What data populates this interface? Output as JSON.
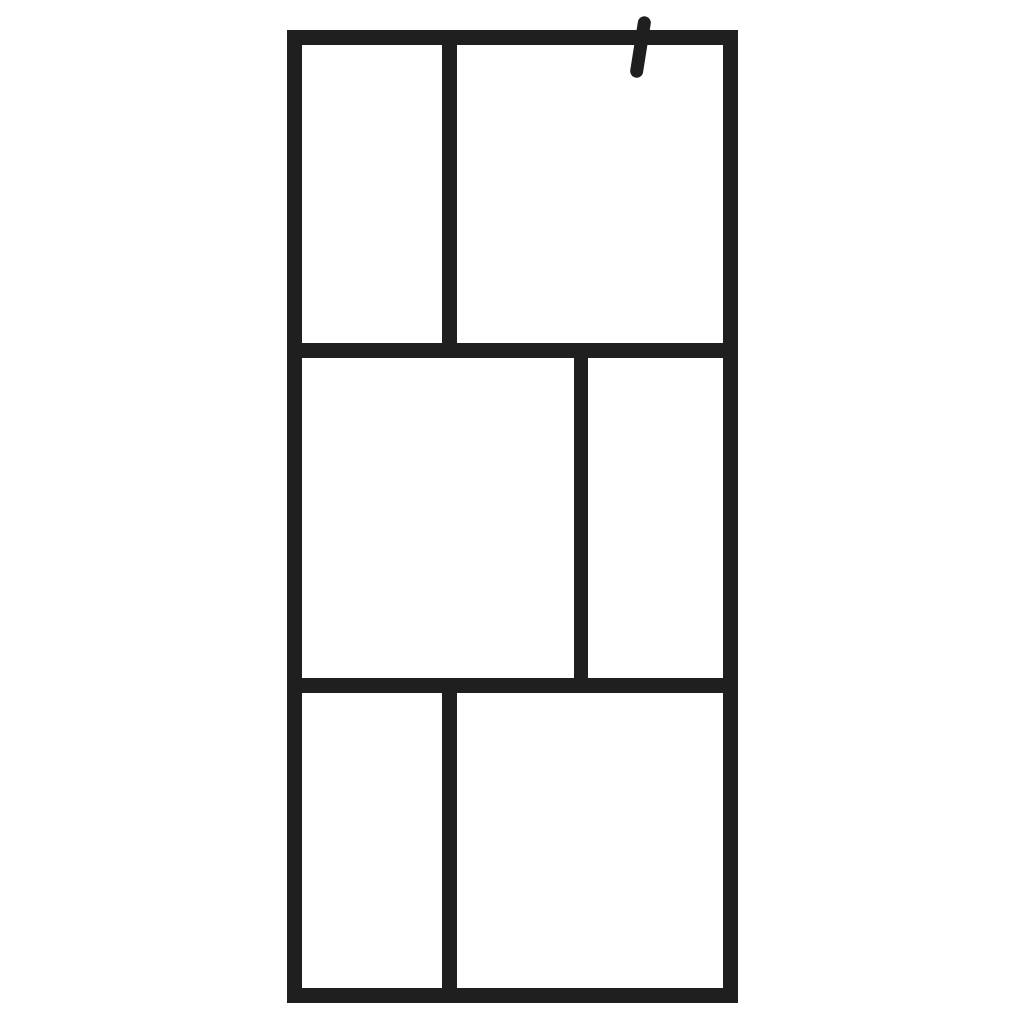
{
  "image": {
    "type": "product-photo",
    "subject": "walk-in shower glass screen with black six-pane grid frame and wall-mount bracket stub",
    "colors": {
      "background": "#ffffff",
      "frame": "#201f1f",
      "glass": "#ffffff"
    },
    "parts": {
      "frame": "black metal frame, 3 rows",
      "bracket": "wall-mount bracket stub, top right, tilted",
      "panes": [
        "top-left",
        "top-right",
        "middle-left",
        "middle-right",
        "bottom-left",
        "bottom-right"
      ]
    }
  }
}
